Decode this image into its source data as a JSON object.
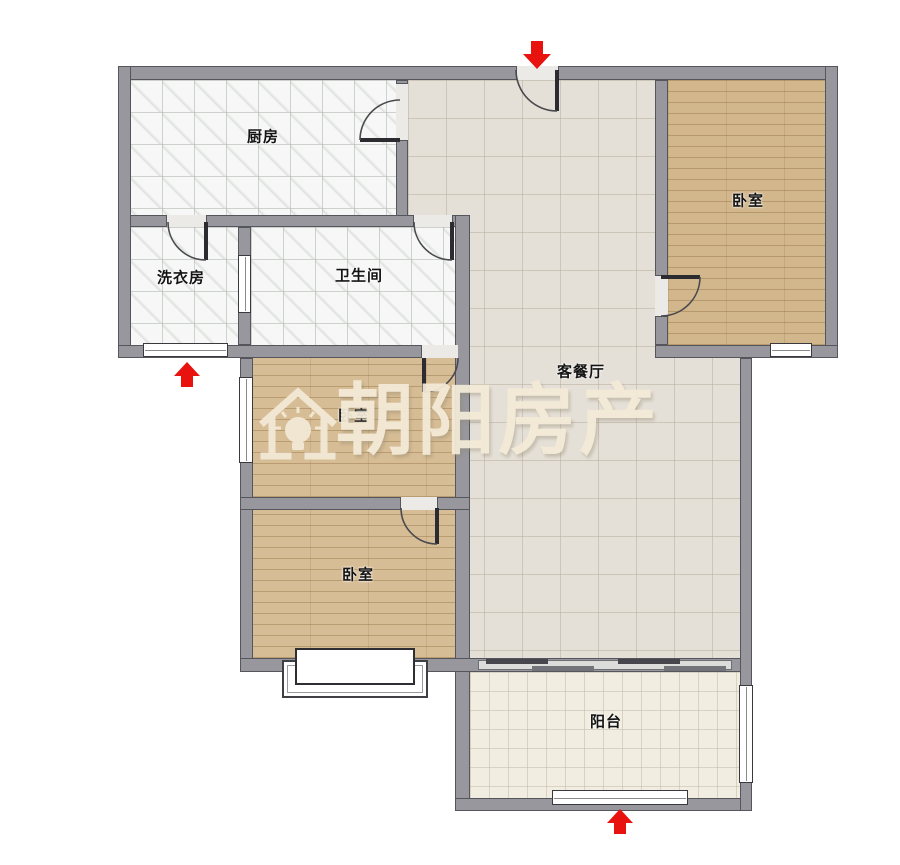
{
  "watermark": {
    "brand_text": "朝阳房产",
    "logo_icon": "house-with-lightbulb"
  },
  "rooms": {
    "kitchen": {
      "label": "厨房"
    },
    "laundry": {
      "label": "洗衣房"
    },
    "bathroom": {
      "label": "卫生间"
    },
    "bedroom_top_right": {
      "label": "卧室"
    },
    "living_dining": {
      "label": "客餐厅"
    },
    "bedroom_middle_left": {
      "label": "卧室"
    },
    "bedroom_bottom_left": {
      "label": "卧室"
    },
    "balcony": {
      "label": "阳台"
    }
  },
  "markers": {
    "entry_arrow_top": "red-arrow-down",
    "arrow_left": "red-arrow-up",
    "arrow_bottom": "red-arrow-up"
  },
  "colors": {
    "wall": "#97979d",
    "wall_edge": "#55555c",
    "wood_floor": "#d7bd95",
    "wood_floor_dark": "#d2b68c",
    "tile_white": "#f6f7f6",
    "tile_living": "#e5e0d7",
    "tile_balcony": "#f1ede1",
    "arrow_red": "#e8120e",
    "watermark_cream": "#f3ead7"
  }
}
